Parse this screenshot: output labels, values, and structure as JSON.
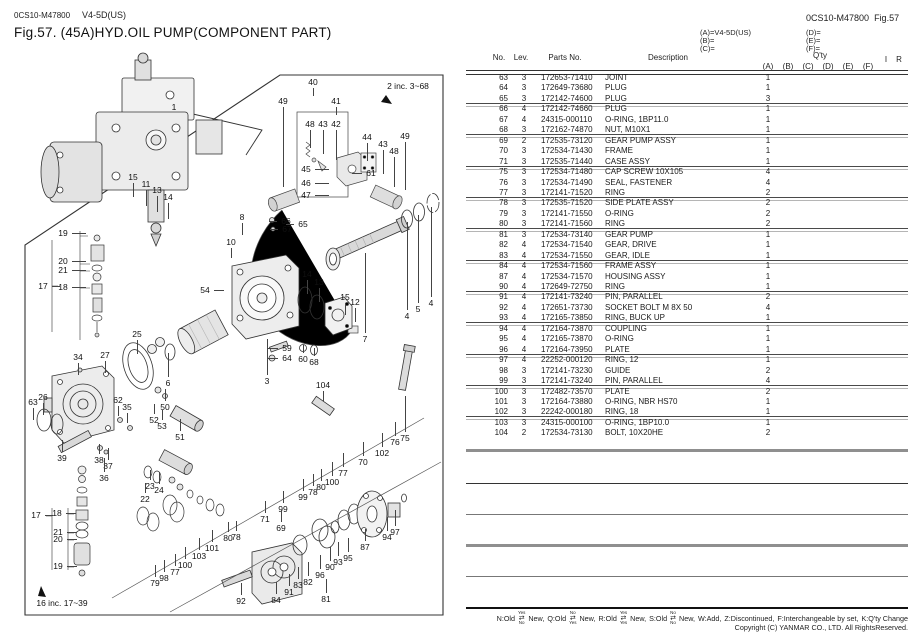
{
  "header": {
    "doc_code": "0CS10-M47800",
    "model": "V4-5D(US)",
    "title": "Fig.57.  (45A)HYD.OIL PUMP(COMPONENT PART)",
    "right_code": "0CS10-M47800",
    "right_fig": "Fig.57"
  },
  "variants": {
    "a": "(A)=V4-5D(US)",
    "b": "(B)=",
    "c": "(C)=",
    "d": "(D)=",
    "e": "(E)=",
    "f": "(F)="
  },
  "table": {
    "headers": {
      "no": "No.",
      "lev": "Lev.",
      "parts": "Parts No.",
      "desc": "Description",
      "qty": "Q'ty",
      "qty_cols": [
        "(A)",
        "(B)",
        "(C)",
        "(D)",
        "(E)",
        "(F)"
      ],
      "i": "I",
      "r": "R"
    },
    "rows": [
      {
        "no": "63",
        "lev": "3",
        "parts": "172653-71410",
        "desc": "JOINT",
        "qty_a": "1",
        "sep": false
      },
      {
        "no": "64",
        "lev": "3",
        "parts": "172649-73680",
        "desc": "PLUG",
        "qty_a": "1",
        "sep": false
      },
      {
        "no": "65",
        "lev": "3",
        "parts": "172142-74600",
        "desc": "PLUG",
        "qty_a": "3",
        "sep": true
      },
      {
        "no": "66",
        "lev": "4",
        "parts": "172142-74660",
        "desc": "PLUG",
        "qty_a": "1",
        "sep": false
      },
      {
        "no": "67",
        "lev": "4",
        "parts": "24315-000110",
        "desc": "O-RING, 1BP11.0",
        "qty_a": "1",
        "sep": false
      },
      {
        "no": "68",
        "lev": "3",
        "parts": "172162-74870",
        "desc": "NUT, M10X1",
        "qty_a": "1",
        "sep": true
      },
      {
        "no": "69",
        "lev": "2",
        "parts": "172535-73120",
        "desc": "GEAR PUMP ASSY",
        "qty_a": "1",
        "sep": false
      },
      {
        "no": "70",
        "lev": "3",
        "parts": "172534-71430",
        "desc": "FRAME",
        "qty_a": "1",
        "sep": false
      },
      {
        "no": "71",
        "lev": "3",
        "parts": "172535-71440",
        "desc": "CASE ASSY",
        "qty_a": "1",
        "sep": true
      },
      {
        "no": "75",
        "lev": "3",
        "parts": "172534-71480",
        "desc": "CAP SCREW 10X105",
        "qty_a": "4",
        "sep": false
      },
      {
        "no": "76",
        "lev": "3",
        "parts": "172534-71490",
        "desc": "SEAL, FASTENER",
        "qty_a": "4",
        "sep": false
      },
      {
        "no": "77",
        "lev": "3",
        "parts": "172141-71520",
        "desc": "RING",
        "qty_a": "2",
        "sep": true
      },
      {
        "no": "78",
        "lev": "3",
        "parts": "172535-71520",
        "desc": "SIDE PLATE ASSY",
        "qty_a": "2",
        "sep": false
      },
      {
        "no": "79",
        "lev": "3",
        "parts": "172141-71550",
        "desc": "O-RING",
        "qty_a": "2",
        "sep": false
      },
      {
        "no": "80",
        "lev": "3",
        "parts": "172141-71560",
        "desc": "RING",
        "qty_a": "2",
        "sep": true
      },
      {
        "no": "81",
        "lev": "3",
        "parts": "172534-73140",
        "desc": "GEAR PUMP",
        "qty_a": "1",
        "sep": false
      },
      {
        "no": "82",
        "lev": "4",
        "parts": "172534-71540",
        "desc": "GEAR, DRIVE",
        "qty_a": "1",
        "sep": false
      },
      {
        "no": "83",
        "lev": "4",
        "parts": "172534-71550",
        "desc": "GEAR, IDLE",
        "qty_a": "1",
        "sep": true
      },
      {
        "no": "84",
        "lev": "4",
        "parts": "172534-71560",
        "desc": "FRAME ASSY",
        "qty_a": "1",
        "sep": false
      },
      {
        "no": "87",
        "lev": "4",
        "parts": "172534-71570",
        "desc": "HOUSING ASSY",
        "qty_a": "1",
        "sep": false
      },
      {
        "no": "90",
        "lev": "4",
        "parts": "172649-72750",
        "desc": "RING",
        "qty_a": "1",
        "sep": true
      },
      {
        "no": "91",
        "lev": "4",
        "parts": "172141-73240",
        "desc": "PIN, PARALLEL",
        "qty_a": "2",
        "sep": false
      },
      {
        "no": "92",
        "lev": "4",
        "parts": "172651-73730",
        "desc": "SOCKET BOLT M 8X 50",
        "qty_a": "4",
        "sep": false
      },
      {
        "no": "93",
        "lev": "4",
        "parts": "172165-73850",
        "desc": "RING, BUCK UP",
        "qty_a": "1",
        "sep": true
      },
      {
        "no": "94",
        "lev": "4",
        "parts": "172164-73870",
        "desc": "COUPLING",
        "qty_a": "1",
        "sep": false
      },
      {
        "no": "95",
        "lev": "4",
        "parts": "172165-73870",
        "desc": "O-RING",
        "qty_a": "1",
        "sep": false
      },
      {
        "no": "96",
        "lev": "4",
        "parts": "172164-73950",
        "desc": "PLATE",
        "qty_a": "1",
        "sep": true
      },
      {
        "no": "97",
        "lev": "4",
        "parts": "22252-000120",
        "desc": "RING,  12",
        "qty_a": "1",
        "sep": false
      },
      {
        "no": "98",
        "lev": "3",
        "parts": "172141-73230",
        "desc": "GUIDE",
        "qty_a": "2",
        "sep": false
      },
      {
        "no": "99",
        "lev": "3",
        "parts": "172141-73240",
        "desc": "PIN, PARALLEL",
        "qty_a": "4",
        "sep": true
      },
      {
        "no": "100",
        "lev": "3",
        "parts": "172482-73570",
        "desc": "PLATE",
        "qty_a": "2",
        "sep": false
      },
      {
        "no": "101",
        "lev": "3",
        "parts": "172164-73880",
        "desc": "O-RING, NBR HS70",
        "qty_a": "1",
        "sep": false
      },
      {
        "no": "102",
        "lev": "3",
        "parts": "22242-000180",
        "desc": "RING,  18",
        "qty_a": "1",
        "sep": true
      },
      {
        "no": "103",
        "lev": "3",
        "parts": "24315-000100",
        "desc": "O-RING, 1BP10.0",
        "qty_a": "1",
        "sep": false
      },
      {
        "no": "104",
        "lev": "2",
        "parts": "172534-73130",
        "desc": "BOLT, 10X20HE",
        "qty_a": "2",
        "sep": false
      }
    ]
  },
  "diagram": {
    "inc2": "2 inc. 3~68",
    "inc16": "16  inc. 17~39",
    "callouts": [
      {
        "t": "1",
        "x": 174,
        "y": 107
      },
      {
        "t": "40",
        "x": 313,
        "y": 82,
        "ld": "d",
        "len": 8
      },
      {
        "t": "49",
        "x": 283,
        "y": 101,
        "ld": "d",
        "len": 80
      },
      {
        "t": "41",
        "x": 336,
        "y": 101,
        "ld": "d",
        "len": 8
      },
      {
        "t": "48",
        "x": 310,
        "y": 124,
        "ld": "d",
        "len": 18
      },
      {
        "t": "43",
        "x": 323,
        "y": 124,
        "ld": "d",
        "len": 24
      },
      {
        "t": "42",
        "x": 336,
        "y": 124,
        "ld": "d",
        "len": 30
      },
      {
        "t": "44",
        "x": 367,
        "y": 137,
        "ld": "d",
        "len": 18
      },
      {
        "t": "43",
        "x": 383,
        "y": 144,
        "ld": "d",
        "len": 24
      },
      {
        "t": "48",
        "x": 394,
        "y": 151,
        "ld": "d",
        "len": 30
      },
      {
        "t": "49",
        "x": 405,
        "y": 136,
        "ld": "d",
        "len": 48
      },
      {
        "t": "45",
        "x": 306,
        "y": 169,
        "ld": "r",
        "len": 14
      },
      {
        "t": "46",
        "x": 306,
        "y": 183,
        "ld": "r",
        "len": 14
      },
      {
        "t": "47",
        "x": 306,
        "y": 195,
        "ld": "r",
        "len": 14
      },
      {
        "t": "61",
        "x": 371,
        "y": 173,
        "ld": "l",
        "len": 10
      },
      {
        "t": "8",
        "x": 242,
        "y": 217,
        "ld": "d",
        "len": 12
      },
      {
        "t": "10",
        "x": 231,
        "y": 242,
        "ld": "d",
        "len": 10
      },
      {
        "t": "66",
        "x": 286,
        "y": 221,
        "ld": "l",
        "len": 8
      },
      {
        "t": "67",
        "x": 287,
        "y": 229,
        "ld": "l",
        "len": 8
      },
      {
        "t": "65",
        "x": 303,
        "y": 224,
        "ld": "l",
        "len": 8
      },
      {
        "t": "15",
        "x": 133,
        "y": 177,
        "ld": "d",
        "len": 14
      },
      {
        "t": "11",
        "x": 146,
        "y": 184,
        "ld": "d",
        "len": 16
      },
      {
        "t": "13",
        "x": 157,
        "y": 190,
        "ld": "d",
        "len": 16
      },
      {
        "t": "14",
        "x": 168,
        "y": 197,
        "ld": "d",
        "len": 16
      },
      {
        "t": "19",
        "x": 63,
        "y": 233,
        "ld": "r",
        "len": 14
      },
      {
        "t": "20",
        "x": 63,
        "y": 261,
        "ld": "r",
        "len": 14
      },
      {
        "t": "21",
        "x": 63,
        "y": 270,
        "ld": "r",
        "len": 14
      },
      {
        "t": "17",
        "x": 43,
        "y": 286,
        "ld": "r",
        "len": 8
      },
      {
        "t": "18",
        "x": 63,
        "y": 287,
        "ld": "r",
        "len": 14
      },
      {
        "t": "54",
        "x": 205,
        "y": 290,
        "ld": "r",
        "len": 10
      },
      {
        "t": "25",
        "x": 137,
        "y": 334,
        "ld": "d",
        "len": 14
      },
      {
        "t": "34",
        "x": 78,
        "y": 357,
        "ld": "d",
        "len": 12
      },
      {
        "t": "27",
        "x": 105,
        "y": 355,
        "ld": "d",
        "len": 12
      },
      {
        "t": "26",
        "x": 43,
        "y": 397,
        "ld": "d",
        "len": 12
      },
      {
        "t": "63",
        "x": 33,
        "y": 402,
        "ld": "d",
        "len": 12
      },
      {
        "t": "62",
        "x": 118,
        "y": 400,
        "ld": "d",
        "len": 10
      },
      {
        "t": "35",
        "x": 127,
        "y": 407,
        "ld": "d",
        "len": 10
      },
      {
        "t": "6",
        "x": 168,
        "y": 383,
        "ld": "u",
        "len": 24
      },
      {
        "t": "50",
        "x": 165,
        "y": 407,
        "ld": "u",
        "len": 12
      },
      {
        "t": "52",
        "x": 154,
        "y": 420,
        "ld": "u",
        "len": 10
      },
      {
        "t": "53",
        "x": 162,
        "y": 426,
        "ld": "u",
        "len": 10
      },
      {
        "t": "51",
        "x": 180,
        "y": 437,
        "ld": "u",
        "len": 12
      },
      {
        "t": "39",
        "x": 62,
        "y": 458,
        "ld": "u",
        "len": 12
      },
      {
        "t": "38",
        "x": 99,
        "y": 460,
        "ld": "u",
        "len": 10
      },
      {
        "t": "37",
        "x": 108,
        "y": 466,
        "ld": "u",
        "len": 12
      },
      {
        "t": "36",
        "x": 104,
        "y": 478,
        "ld": "u",
        "len": 14
      },
      {
        "t": "17",
        "x": 36,
        "y": 515,
        "ld": "r",
        "len": 8
      },
      {
        "t": "18",
        "x": 57,
        "y": 513,
        "ld": "r",
        "len": 10
      },
      {
        "t": "21",
        "x": 58,
        "y": 532,
        "ld": "r",
        "len": 10
      },
      {
        "t": "20",
        "x": 58,
        "y": 539,
        "ld": "r",
        "len": 10
      },
      {
        "t": "19",
        "x": 58,
        "y": 566,
        "ld": "r",
        "len": 10
      },
      {
        "t": "23",
        "x": 150,
        "y": 486,
        "ld": "u",
        "len": 10
      },
      {
        "t": "24",
        "x": 159,
        "y": 490,
        "ld": "u",
        "len": 12
      },
      {
        "t": "22",
        "x": 145,
        "y": 499,
        "ld": "u",
        "len": 10
      },
      {
        "t": "14",
        "x": 307,
        "y": 274,
        "ld": "d",
        "len": 14
      },
      {
        "t": "13",
        "x": 319,
        "y": 282,
        "ld": "d",
        "len": 14
      },
      {
        "t": "15",
        "x": 345,
        "y": 297,
        "ld": "d",
        "len": 12
      },
      {
        "t": "12",
        "x": 355,
        "y": 302,
        "ld": "d",
        "len": 14
      },
      {
        "t": "4",
        "x": 407,
        "y": 316,
        "ld": "u",
        "len": 88
      },
      {
        "t": "5",
        "x": 418,
        "y": 309,
        "ld": "u",
        "len": 88
      },
      {
        "t": "4",
        "x": 431,
        "y": 303,
        "ld": "u",
        "len": 90
      },
      {
        "t": "7",
        "x": 365,
        "y": 339,
        "ld": "u",
        "len": 80
      },
      {
        "t": "59",
        "x": 287,
        "y": 348,
        "ld": "l",
        "len": 10
      },
      {
        "t": "64",
        "x": 287,
        "y": 358,
        "ld": "l",
        "len": 10
      },
      {
        "t": "60",
        "x": 303,
        "y": 359,
        "ld": "u",
        "len": 8
      },
      {
        "t": "68",
        "x": 314,
        "y": 362,
        "ld": "u",
        "len": 8
      },
      {
        "t": "3",
        "x": 267,
        "y": 381,
        "ld": "u",
        "len": 36
      },
      {
        "t": "104",
        "x": 323,
        "y": 385,
        "ld": "d",
        "len": 10
      },
      {
        "t": "76",
        "x": 395,
        "y": 442,
        "ld": "u",
        "len": 14
      },
      {
        "t": "75",
        "x": 405,
        "y": 438,
        "ld": "u",
        "len": 36
      },
      {
        "t": "102",
        "x": 382,
        "y": 453,
        "ld": "u",
        "len": 14
      },
      {
        "t": "70",
        "x": 363,
        "y": 462,
        "ld": "u",
        "len": 14
      },
      {
        "t": "77",
        "x": 343,
        "y": 473,
        "ld": "u",
        "len": 14
      },
      {
        "t": "100",
        "x": 332,
        "y": 482,
        "ld": "u",
        "len": 14
      },
      {
        "t": "80",
        "x": 321,
        "y": 487,
        "ld": "u",
        "len": 12
      },
      {
        "t": "78",
        "x": 313,
        "y": 492,
        "ld": "u",
        "len": 12
      },
      {
        "t": "99",
        "x": 303,
        "y": 497,
        "ld": "u",
        "len": 12
      },
      {
        "t": "99",
        "x": 283,
        "y": 509,
        "ld": "u",
        "len": 12
      },
      {
        "t": "71",
        "x": 265,
        "y": 519,
        "ld": "u",
        "len": 12
      },
      {
        "t": "69",
        "x": 281,
        "y": 528,
        "ld": "u",
        "len": 12
      },
      {
        "t": "80",
        "x": 228,
        "y": 538,
        "ld": "u",
        "len": 10
      },
      {
        "t": "78",
        "x": 236,
        "y": 537,
        "ld": "u",
        "len": 10
      },
      {
        "t": "94",
        "x": 387,
        "y": 537,
        "ld": "u",
        "len": 14
      },
      {
        "t": "97",
        "x": 395,
        "y": 532,
        "ld": "u",
        "len": 16
      },
      {
        "t": "87",
        "x": 365,
        "y": 547,
        "ld": "u",
        "len": 12
      },
      {
        "t": "95",
        "x": 348,
        "y": 558,
        "ld": "u",
        "len": 14
      },
      {
        "t": "93",
        "x": 338,
        "y": 562,
        "ld": "u",
        "len": 14
      },
      {
        "t": "90",
        "x": 330,
        "y": 567,
        "ld": "u",
        "len": 14
      },
      {
        "t": "96",
        "x": 320,
        "y": 575,
        "ld": "u",
        "len": 14
      },
      {
        "t": "82",
        "x": 308,
        "y": 582,
        "ld": "u",
        "len": 14
      },
      {
        "t": "83",
        "x": 298,
        "y": 585,
        "ld": "u",
        "len": 12
      },
      {
        "t": "91",
        "x": 289,
        "y": 592,
        "ld": "u",
        "len": 12
      },
      {
        "t": "84",
        "x": 276,
        "y": 600,
        "ld": "u",
        "len": 12
      },
      {
        "t": "92",
        "x": 241,
        "y": 601,
        "ld": "u",
        "len": 12
      },
      {
        "t": "81",
        "x": 326,
        "y": 599,
        "ld": "u",
        "len": 14
      },
      {
        "t": "79",
        "x": 155,
        "y": 583,
        "ld": "u",
        "len": 12
      },
      {
        "t": "98",
        "x": 164,
        "y": 578,
        "ld": "u",
        "len": 12
      },
      {
        "t": "77",
        "x": 175,
        "y": 572,
        "ld": "u",
        "len": 12
      },
      {
        "t": "100",
        "x": 185,
        "y": 565,
        "ld": "u",
        "len": 12
      },
      {
        "t": "103",
        "x": 199,
        "y": 556,
        "ld": "u",
        "len": 12
      },
      {
        "t": "101",
        "x": 212,
        "y": 548,
        "ld": "u",
        "len": 12
      }
    ]
  },
  "footer": {
    "legend": [
      {
        "text": "N:Old"
      },
      {
        "arrow": {
          "top": "Yes",
          "bottom": "No"
        }
      },
      {
        "text": "New,"
      },
      {
        "text": "Q:Old"
      },
      {
        "arrow": {
          "top": "No",
          "bottom": "Yes"
        }
      },
      {
        "text": "New,"
      },
      {
        "text": "R:Old"
      },
      {
        "arrow": {
          "top": "Yes",
          "bottom": "Yes"
        }
      },
      {
        "text": "New,"
      },
      {
        "text": "S:Old"
      },
      {
        "arrow": {
          "top": "No",
          "bottom": "No"
        }
      },
      {
        "text": "New,"
      },
      {
        "text": "W:Add,"
      },
      {
        "text": "Z:Discontinued,"
      },
      {
        "text": "F:Interchangeable by set,"
      },
      {
        "text": "K:Q'ty Change"
      }
    ],
    "copyright": "Copyright (C)  YANMAR CO., LTD. All RightsReserved."
  }
}
